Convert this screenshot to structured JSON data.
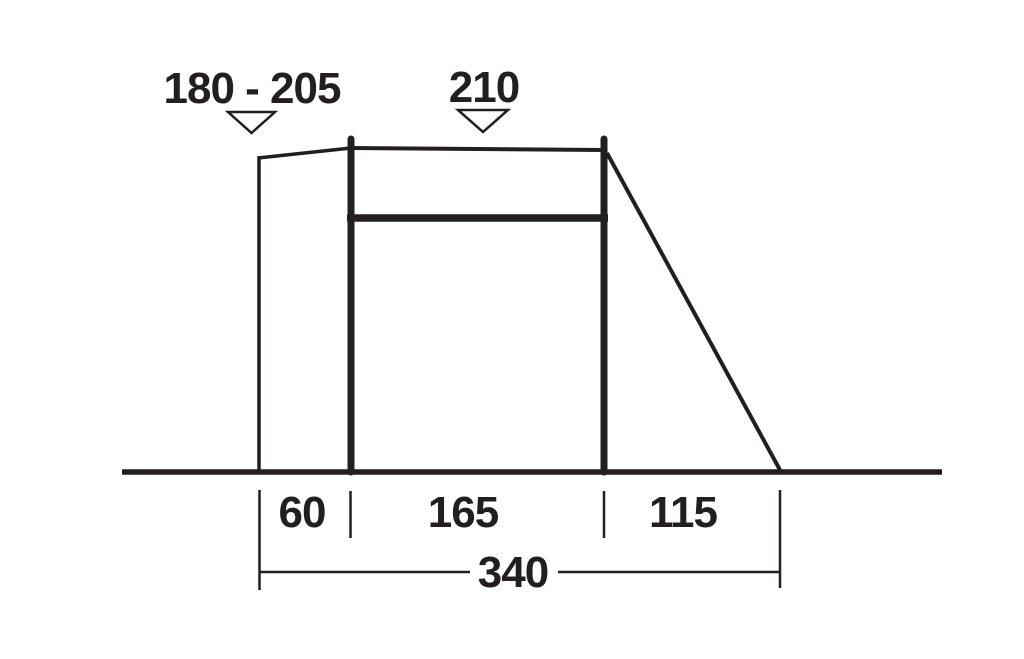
{
  "colors": {
    "ink": "#231f20",
    "background": "#ffffff"
  },
  "diagram": {
    "type": "tent-side-profile-dimension-drawing",
    "height_markers": [
      {
        "label": "180 - 205",
        "icon": "triangle-down"
      },
      {
        "label": "210",
        "icon": "triangle-down"
      }
    ],
    "ground_segments": [
      {
        "label": "60"
      },
      {
        "label": "165"
      },
      {
        "label": "115"
      }
    ],
    "overall_width": {
      "label": "340"
    }
  }
}
